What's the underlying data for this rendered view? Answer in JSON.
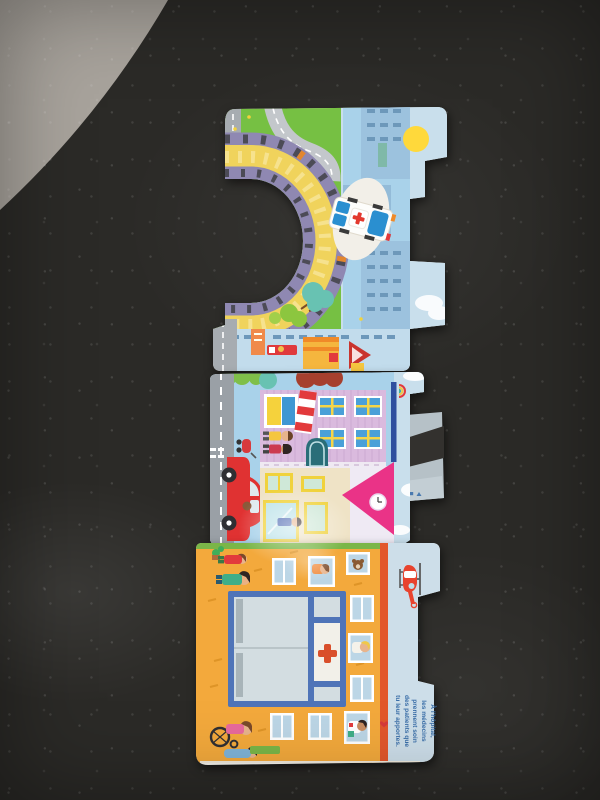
{
  "caption": {
    "lines": [
      "À l'hôpital,",
      "les médecins",
      "prennent soin",
      "des patients que",
      "tu leur apportes."
    ]
  },
  "palette": {
    "floor": "#a8a39c",
    "table": "#2b2a27",
    "page": "#f4f1ea",
    "grass": "#76c043",
    "road": "#a7acb1",
    "ring_yellow": "#f0d35c",
    "ring_purple": "#8f88b2",
    "sky": "#a9d2ea",
    "sky_pale": "#c9dfec",
    "building": "#9cc2de",
    "sun": "#ffd93b",
    "house": "#dabade",
    "window_blue": "#4aa0d8",
    "awning_red": "#e23a3c",
    "cream": "#efe3c6",
    "roof_pink": "#ea3387",
    "car_red": "#e03232",
    "facade": "#f3a93c",
    "stripe": "#e2572b",
    "panel": "#cddee9",
    "entrance": "#4f74b8",
    "glass": "#d3dde1",
    "cross_red": "#d94f2b",
    "caption_blue": "#3a6ea8",
    "green": "#7ab648"
  },
  "icons": {
    "sun": "yellow-circle",
    "red_cross": "✚",
    "ambulance": "ambulance-top-lights",
    "helicopter": "helicopter-side-view",
    "rainbow": "rainbow-arcs",
    "clock": "clock-face",
    "heart": "❤",
    "teddy_bear": "teddy-bear-head",
    "flap_icons": "tiny-blue-glyphs"
  }
}
